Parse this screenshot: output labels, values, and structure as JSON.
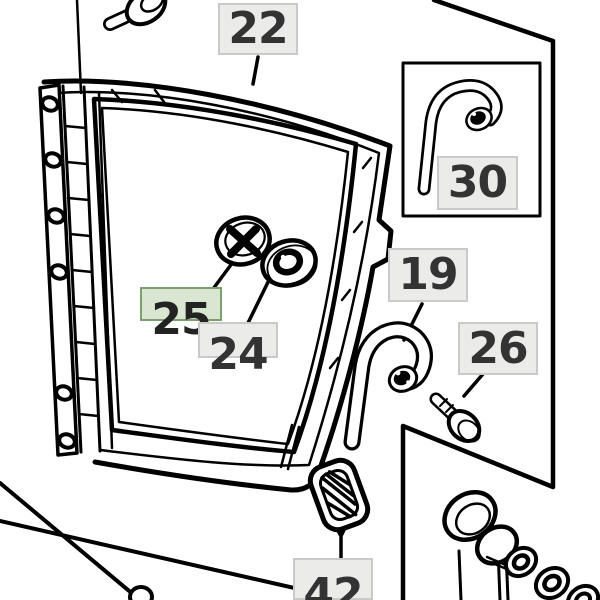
{
  "diagram": {
    "selected_part": "25",
    "labels": {
      "l22": {
        "text": "22"
      },
      "l30": {
        "text": "30"
      },
      "l19": {
        "text": "19"
      },
      "l26": {
        "text": "26"
      },
      "l25": {
        "text": "25"
      },
      "l24": {
        "text": "24"
      },
      "l42": {
        "text": "42"
      }
    },
    "colors": {
      "background": "#ffffff",
      "line": "#000000",
      "label_background": "#ebebe9",
      "label_border": "#c9c9c7",
      "label_text": "#333333",
      "highlight_background": "#d9e6d1",
      "highlight_border": "#7ba06d",
      "highlight_text": "#232323"
    }
  }
}
